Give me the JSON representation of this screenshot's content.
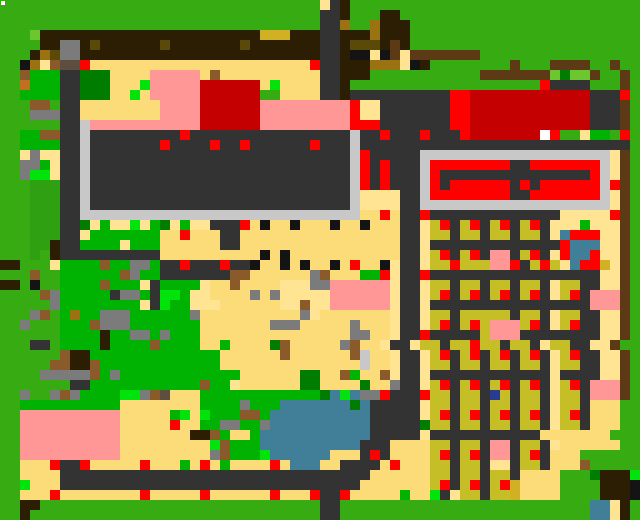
{
  "map": {
    "cols": 64,
    "rows": 52,
    "cell": 10,
    "palette": {
      "G": "#36AC12",
      "g": "#00B303",
      "h": "#2FA012",
      "f": "#007D00",
      "l": "#6CC62F",
      "n": "#00E40B",
      "S": "#FBDC78",
      "Y": "#FFE593",
      "D": "#333333",
      "c": "#C8C8C8",
      "e": "#7B7B7B",
      "v": "#5E4E3F",
      "R": "#FE0000",
      "r": "#C40001",
      "P": "#FF9797",
      "B": "#2B1E03",
      "b": "#5B4A07",
      "o": "#9A7212",
      "y": "#D1B024",
      "K": "#C5BE27",
      "T": "#5C3A15",
      "t": "#8B5A2B",
      "A": "#407F97",
      "W": "#FFFFFF",
      "k": "#141414",
      "N": "#2A3C8F",
      "C": "#C0711F"
    },
    "palette_names": {
      "G": "grass",
      "g": "bright-grass",
      "h": "mid-grass",
      "f": "dark-green",
      "l": "light-green",
      "n": "lime",
      "S": "sand",
      "Y": "pale-sand",
      "D": "road-charcoal",
      "c": "concrete-light-gray",
      "e": "stone-gray",
      "v": "taupe",
      "R": "red",
      "r": "dark-red-roof",
      "P": "pink-roof",
      "B": "dark-brown",
      "b": "dark-olive",
      "o": "olive-brown",
      "y": "gold",
      "K": "khaki-plot",
      "T": "fence-brown",
      "t": "dirt-brown",
      "A": "water-teal",
      "W": "white",
      "k": "black",
      "N": "navy",
      "C": "orange-brown"
    },
    "grid": [
      "GGGGGGGGGGGGGGGGGGGGGGGGGGGGGGGGYDBGGGGGGGGGGGGGGGGGGGGGGGGGGGG",
      "GGGGGGGGGGGGGGGGGGGGGGGGGGGGGGGGDDBGGGBBGGGGGGGGGGGGGGGGGGGGGGG",
      "GGGGGGGGGGGGGGGGGGGGGGGGGGGGGGGGDDoGGoBBBGGGGGGGGGGGGGGGGGGGGGG",
      "GGGlBBBBBBBBBBBBBBBBBBBBBByyyBBBDDBBBoBBBGGGGGGGGGGGGGGGGGGGGGG",
      "GGGGBBeeBbBBBBBBbBBBBBBBbBBBBBBBDDBbbbBTBGGGGGGGGGGGGGGGGGGGGGG",
      "GGGBobeeBBBBBBBBBBBBBBBBBBBBBBBBDDBkkYkTYTTTTTTTGGGGGGGGGGGGGGGG",
      "GGkoYtvvRSSSSSSSSSSSSSSSSSSSSSSRDDBBBoooYkBGGGGGGGGTGGGTTTTGGTG",
      "GGtgggDDfffSSSSPPPPPStSSSSSSSSSSDDBBBGGGGGGGGGGGTTTTTTTlfllTGGTG",
      "GGCgggDDfffSSSnPPPPPrrrrrrSnSSSSDDBGGGGGGGGGGGGGGGGGGGRDDDDGGGTG",
      "GGggggDDfffSSnSPPPPPrrrrrrGGSSSSDDBDDDDDDDDDDRRrrrrrrrrrrrrDDDRG",
      "GGGttGDDSSSSSSSSPPPPrrrrrrPPPPPPPPPRYYDDDDDDDRRrrrrrrrrrrrrDDDTG",
      "GGGeeeDDSSSSSSSSPPPPrrrrrrPPPPPPPPPRYYDDDDDDDRRrrrrrrrrrrrrDDDTG",
      "GGGGGGDDcPPPPPPPPPPPrrrrrrPPPPPPPPPRRRDDDDDDDRRrrrrrrrrrrrrDDDTG",
      "GGggttDDcDDDDDDDDDRDDDDDDDDDDDDDDDDcDDRDDDRDDDRrrrrrrrWRGGYggGRG",
      "GGggggDDcDDDDDDDRDDDDRDDRDDDDDDRDDDcDDDDDDDDDDDDDDDDDDDDDDDDDDDG",
      "GGYeYYDDcDDDDDDDDDDDDDDDDDDDDDDDDDDcRDDDDDcccccccccccccccccccYTG",
      "GGeegYDDcDDDDDDDDDDDDDDDDDDDDDDDDDDcRDRDDDcRRRRRRRRDDRRRRRRRcYTG",
      "GGennYDDcDDDDDDDDDDDDDDDDDDDDDDDDDDcRDRDDDcRDDDDDDDDDDDDDDDRcYTG",
      "GGGhhhDDcDDDDDDDDDDDDDDDDDDDDDDDDDDcRDRDDDcRDRRRRRRDRDRRRRRRcRTG",
      "GGGhhhDDcDDDDDDDDDDDDDDDDDDDDDDDDDDcYYYYDDcRRRRRRRRDDRRRRRRRcYTG",
      "GGGhhhDDcDDDDDDDDDDDDDDDDDDDDDDDDDDcYYYYDDcccccccccccccccccccYTG",
      "GGGhhhDDccccccccccccccccccccccccccccSSRSDDRDDDDDDDDDDDDDYYYYYRTG",
      "GGGhhhDDfYgYYnYgfYgYYDDDRSkSSkSSSkSSkSSSDDYKRDKRDKRDKRDYYYgYYYTG",
      "GGGhhhDDYgggggggSSRSSSDDSSSSSSSSSSSSSSSSDDYKKDKKDKKDKKDYARRRYYTG",
      "GGGhhBDDggggYgggSSSSSSDDSSSSSSSSSSSSSSSSDDYDDDDDDDDDDDDDRAAAYYTG",
      "GGGhGBDDDDDDDDDDSSSSSSSSSSkSkSSSSSSSSSSSDDYKRDKRDPPDKRDYRAARYYTG",
      "BBGGGYggggtggeegDDRDDDRDDkSSkSkSSkSRSSkYDDYKKRKKKPPRDKRKYARRyYTG",
      "GGGtGGggggggteggDDDDDDDttSSSSSSetSSSggRYDDRDDDDDDDDDDDDDDDDDYYTG",
      "BBGkGGggggtgggYDggggYSStSSSSYYYeePPPPPPYDDYKKDKKDKKDKKDYKKDDYYTG",
      "GGGGtegggggDeegDnngYYSSSSeSeYYYYYPPPPPPYDDYKRDKRDKRDKRDYKRDPPPTG",
      "GGGGGeggggggggYDnggYYYSSSSSSYYtYYPPPPPPYDDYDDDDDDDDDDDDDDDDPPPTG",
      "GGGetGgoggeeeggggggeSSSSSSSSSSeYSSSSSSSYDDYKKDKKKKKDKKDYKKDDYYTG",
      "GGeGGGgggteeegggggggSSSSSSSeeeSSSSSeSSSYDDYKRDKRKPPPKRDYKRDDYYTG",
      "GGGGGGggggBggeegegggSSSSSSSSSSSSSSSeeSSYDDRDDDDDKPPPDDDDDDDDYYTG",
      "GGGDDGggggBggggtggggSSgSSSSftSSSSSetSSYDDYKKDKKRKKDKKDYKKDDYYTG",
      "GGGGGGtBBgggggggggggggSSSSSStSSSSSStcSSYDDYKRDKRDKRDKRDYKRDDYYTG",
      "GGGGGttBBtggggggggggggSSSSSSSSSSSSSScSSYDDYKKDKKDKKDKKDYKKDDYYTG",
      "GGGGeeeeetgeggggggggggggSSSSSSffSStgSStYDDYDDDDDDDDDDDDYDDDDYYTG",
      "GGGGGGGDDgggggggggggtggYSSSSSSffSSSSfSSeDDYKRDKRDKRDKRDYKRDPPPTG",
      "GGeGGeteggggnnetvSSSggggggggggggfAnAeeRDDDRKKDKKDNKDKKDYKKDPPPTG",
      "GGggggggggggSSSSSSSSggggegggAAAAAAAfADDDDDYKKDKKDKKDKKDYKKDSSSGG",
      "GGPPPPPPPPPPSSSSSgnSngggttgAAAAAAAAAADDDDDYKRDKRDKRDKRDYKRDSSSGG",
      "GGPPPPPPPPPPSSSSSRSSggeeggeAAAAAAAAAADDDDDfKKDKKDKKDKKDYKKDSSSGG",
      "GGPPPPPPPPPPSSSSSSSBBtgSSgAAAAAAAAAAADDDDDYDDDDDDDDDDDSSSSSSSGG",
      "GGPPPPPPPPPPSSSSSSSSSntgggAAAAAAAAAADDDSSSSKKDKKDPPDKKDYSSSSSSGG",
      "GGPPPPPPPPPPSSSSSSSSSetgggnAAAAAASSSDRDSSSSKRDKRDPPDKRDSSSGGGGGG",
      "GGSSSRDDRSSSSSRSSSgSRSgSSSSRSAAASSDDDDSRSSSKKDKKDYYDKKDSSStGGGGG",
      "GGSSSSDDDDDDDDDDDDDDDDDDDDDDDDDDDDDDDSSSSSSKKDKKDKKDSSSSGGGfBBBn",
      "GGnSSSDDDDDDDDDDDDDDDDDDDDDDDDDDDDDDSSSSSSSKRDKRDKRySSSSGGGGBBBk",
      "GGSSSRSSSSSSSSRSSSSSRSSSSSSRSSSRDDRSSSSSgSSnDYKKDKKySSSSGGGGBBBk",
      "GGBBGGGGGGGGGGGGGGGGGGGGGGGGGGGGDDGGGGGGGGGGGGGGGGGGGGGGGGGAAYB",
      "GGBGGGGGGGGGGGGGGGGGGGGGGGGGGGGGDDGGGGGGGGGGGGGGGGGGGGGGGGGAAYB"
    ],
    "marker": {
      "x": 1,
      "y": 1,
      "size": 4,
      "color": "#FFFFFF"
    }
  }
}
